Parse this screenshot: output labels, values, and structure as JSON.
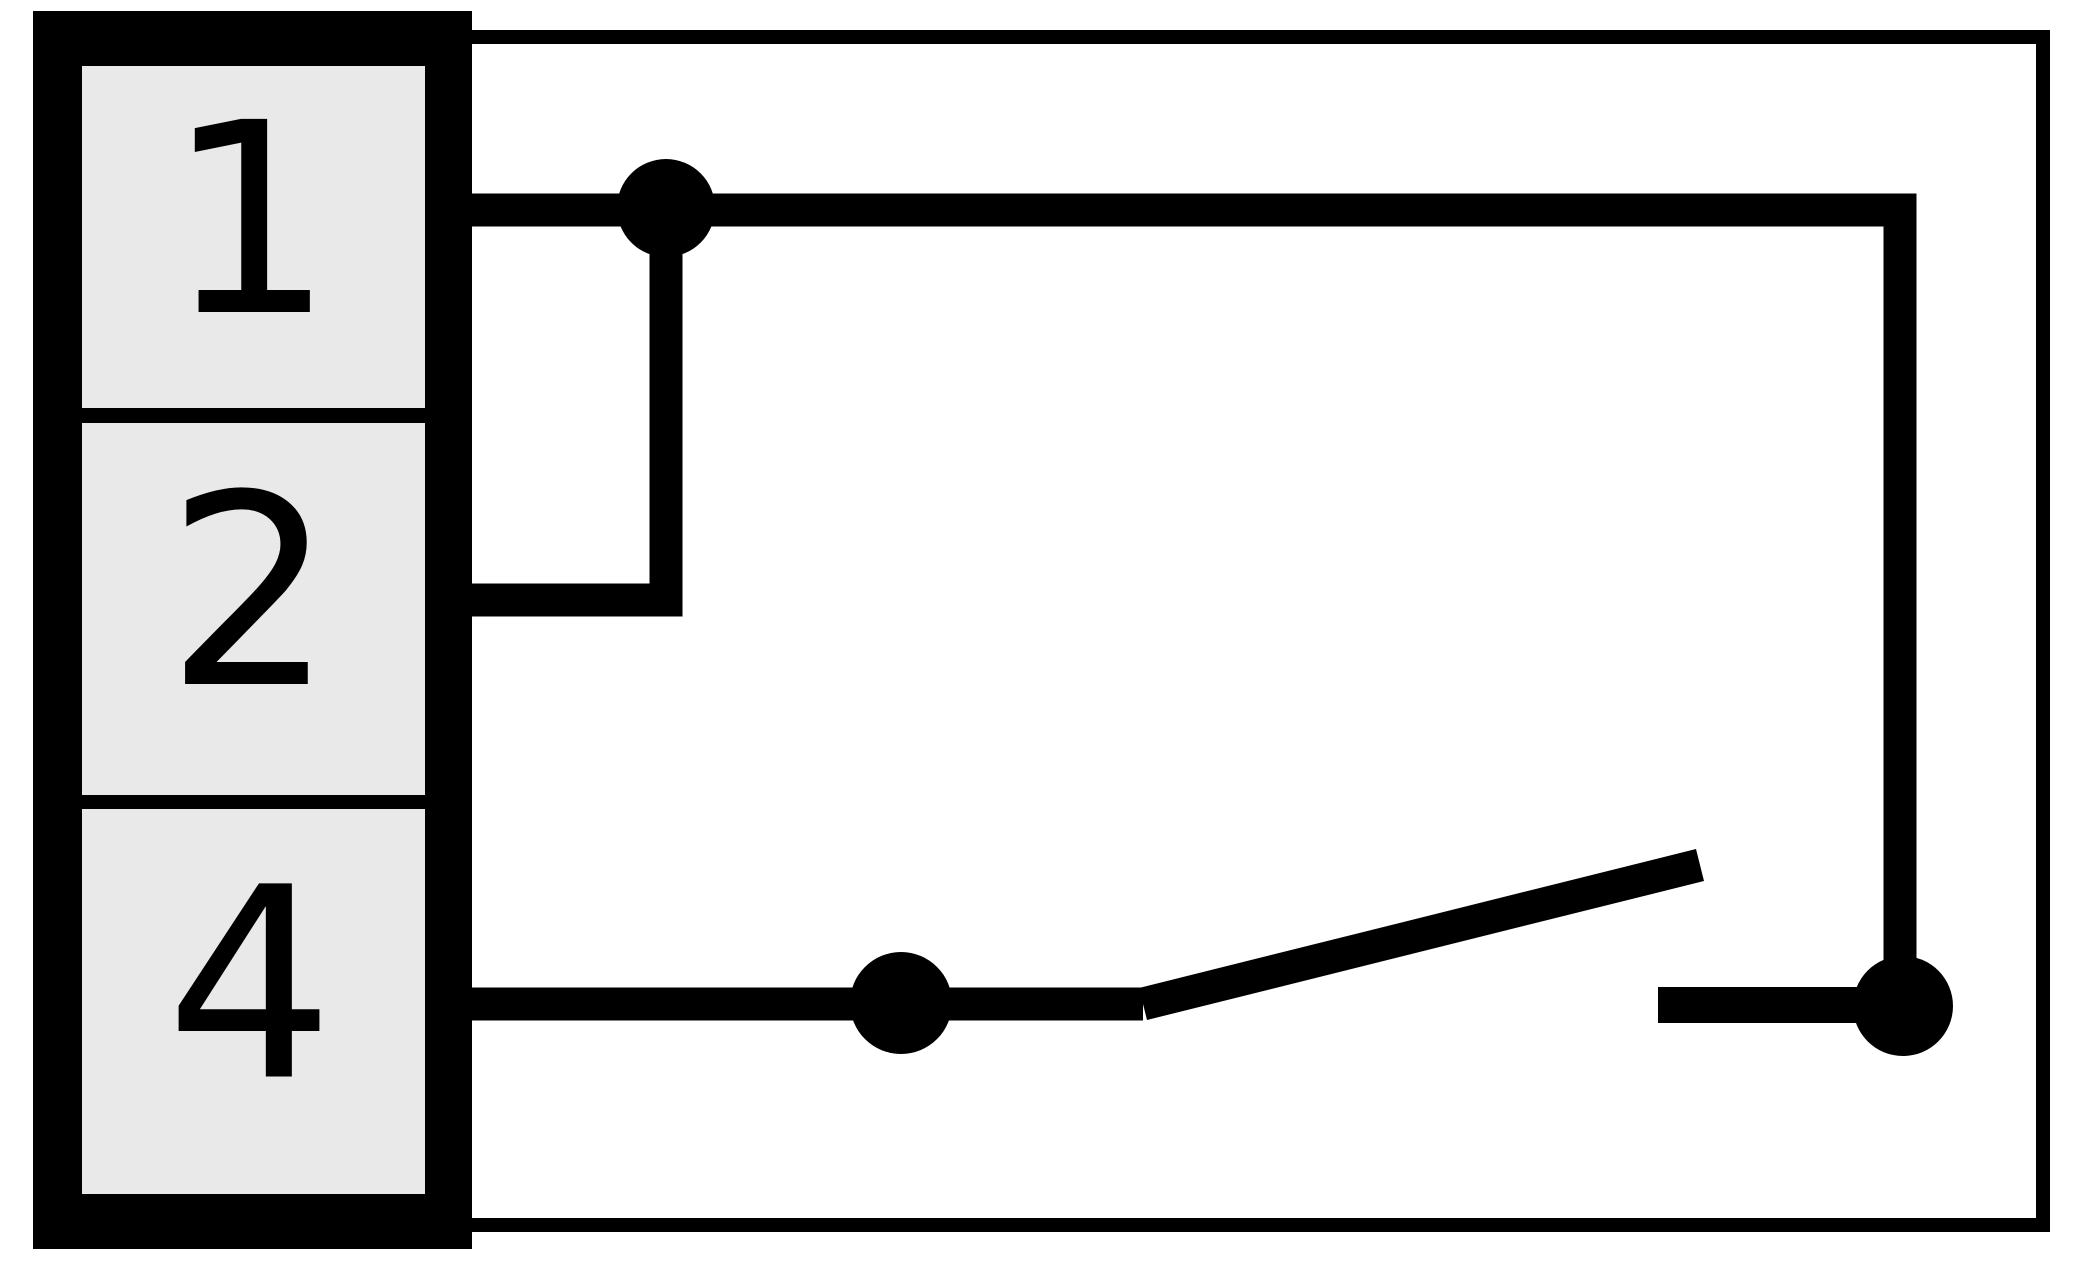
{
  "diagram": {
    "colors": {
      "background": "#ffffff",
      "line": "#000000",
      "terminal_fill": "#e9e9e9"
    },
    "terminals": [
      {
        "label": "1"
      },
      {
        "label": "2"
      },
      {
        "label": "4"
      }
    ],
    "switch_state": "open"
  },
  "geometry": {
    "canvas": {
      "w": 2077,
      "h": 1266
    },
    "outer_frame": {
      "points": [
        [
          452,
          37
        ],
        [
          2043,
          37
        ],
        [
          2043,
          1225
        ],
        [
          452,
          1225
        ]
      ],
      "stroke_width": 14
    },
    "connector": {
      "body": {
        "x": 33,
        "y": 11,
        "w": 439,
        "h": 1238
      },
      "cell_x": 82,
      "cell_w": 343,
      "cells": [
        {
          "y": 66,
          "h": 342
        },
        {
          "y": 423,
          "h": 372
        },
        {
          "y": 809,
          "h": 385
        }
      ],
      "label_font_size": 265,
      "label_center_x": 250,
      "label_baseline_offset": 75
    },
    "wires": [
      {
        "name": "wire-terminal-1",
        "points": [
          [
            472,
            210
          ],
          [
            1900,
            210
          ],
          [
            1900,
            970
          ]
        ],
        "width": 33
      },
      {
        "name": "wire-terminal-2",
        "points": [
          [
            472,
            600
          ],
          [
            666,
            600
          ],
          [
            666,
            210
          ]
        ],
        "width": 33
      },
      {
        "name": "wire-terminal-4",
        "points": [
          [
            472,
            1004
          ],
          [
            1143,
            1004
          ]
        ],
        "width": 33
      },
      {
        "name": "switch-blade",
        "points": [
          [
            1143,
            1004
          ],
          [
            1700,
            865
          ]
        ],
        "width": 33
      },
      {
        "name": "fixed-contact-stub",
        "points": [
          [
            1658,
            1005
          ],
          [
            1903,
            1005
          ]
        ],
        "width": 36
      }
    ],
    "dots": [
      {
        "name": "junction-dot",
        "cx": 666,
        "cy": 208,
        "r": 49
      },
      {
        "name": "pole-contact-dot",
        "cx": 901,
        "cy": 1003,
        "r": 51
      },
      {
        "name": "fixed-contact-dot",
        "cx": 1903,
        "cy": 1006,
        "r": 50
      }
    ]
  }
}
